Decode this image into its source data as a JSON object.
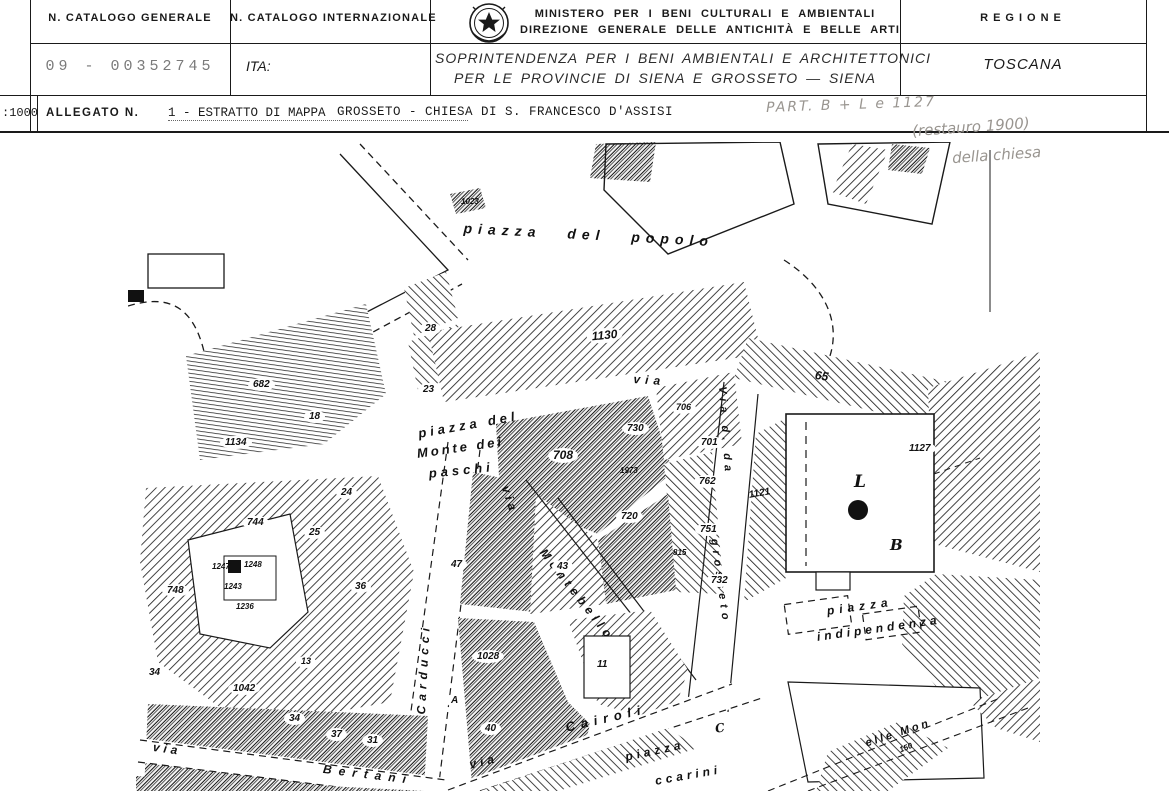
{
  "header": {
    "catalogo_generale": {
      "label": "N. CATALOGO GENERALE",
      "value": "09 - 00352745"
    },
    "catalogo_internazionale": {
      "label": "N. CATALOGO INTERNAZIONALE",
      "value": "ITA:"
    },
    "ministry": {
      "emblem_icon": "italian-state-emblem",
      "line1": "MINISTERO PER I BENI CULTURALI E AMBIENTALI",
      "line2": "DIREZIONE GENERALE DELLE ANTICHITÀ E BELLE ARTI",
      "soprintendenza_line1": "SOPRINTENDENZA PER I BENI AMBIENTALI E ARCHITETTONICI",
      "soprintendenza_line2": "PER LE PROVINCIE DI SIENA E GROSSETO — SIENA"
    },
    "regione": {
      "label": "REGIONE",
      "value": "TOSCANA"
    }
  },
  "allegato_row": {
    "scale": ":1000",
    "label": "ALLEGATO N.",
    "value": "1 - ESTRATTO DI MAPPA",
    "subject": "GROSSETO - CHIESA DI S. FRANCESCO D'ASSISI",
    "handwritten_note": "PART. B + L e 1127"
  },
  "handwritten_annotation": {
    "line1": "(restauro 1900)",
    "line2": "della chiesa"
  },
  "colors": {
    "ink": "#1a1a1a",
    "pencil": "#999590",
    "typewriter_gray": "#7a7a7a",
    "paper": "#ffffff"
  },
  "map": {
    "description": "cadastral-map-extract-1:1000",
    "labels": [
      {
        "t": "piazza del popolo",
        "x": 336,
        "y": 78,
        "rot": 3,
        "ls": 6,
        "ws": 16,
        "fs": 14,
        "kind": "street"
      },
      {
        "t": "piazza del",
        "x": 289,
        "y": 284,
        "rot": -10,
        "ls": 4,
        "fs": 13,
        "kind": "street"
      },
      {
        "t": "Monte dei",
        "x": 288,
        "y": 304,
        "rot": -8,
        "ls": 3,
        "fs": 13,
        "kind": "street"
      },
      {
        "t": "paschi",
        "x": 300,
        "y": 324,
        "rot": -6,
        "ls": 4,
        "fs": 13,
        "kind": "street"
      },
      {
        "t": "via",
        "x": 384,
        "y": 342,
        "rot": 72,
        "ls": 4,
        "fs": 12,
        "kind": "street"
      },
      {
        "t": "Montebello",
        "x": 420,
        "y": 404,
        "rot": 52,
        "ls": 5,
        "fs": 12,
        "kind": "street"
      },
      {
        "t": "Carducci",
        "x": 286,
        "y": 572,
        "rot": -87,
        "ls": 5,
        "fs": 12,
        "kind": "street"
      },
      {
        "t": "Via d. da",
        "x": 600,
        "y": 244,
        "rot": 86,
        "ls": 5,
        "fs": 11,
        "kind": "street"
      },
      {
        "t": "grosseto",
        "x": 592,
        "y": 396,
        "rot": 82,
        "ls": 5,
        "fs": 11,
        "kind": "street"
      },
      {
        "t": "via",
        "x": 506,
        "y": 230,
        "rot": 4,
        "ls": 5,
        "fs": 12,
        "kind": "street"
      },
      {
        "t": "via",
        "x": 26,
        "y": 598,
        "rot": 8,
        "ls": 4,
        "fs": 12,
        "kind": "street"
      },
      {
        "t": "Bertani",
        "x": 196,
        "y": 620,
        "rot": 7,
        "ls": 7,
        "fs": 12,
        "kind": "street"
      },
      {
        "t": "via",
        "x": 340,
        "y": 616,
        "rot": -14,
        "ls": 4,
        "fs": 12,
        "kind": "street"
      },
      {
        "t": "Cairoli",
        "x": 436,
        "y": 578,
        "rot": -13,
        "ls": 6,
        "fs": 13,
        "kind": "street"
      },
      {
        "t": "piazza",
        "x": 698,
        "y": 462,
        "rot": -8,
        "ls": 5,
        "fs": 12,
        "kind": "street"
      },
      {
        "t": "indipendenza",
        "x": 688,
        "y": 488,
        "rot": -8,
        "ls": 4,
        "fs": 12,
        "kind": "street"
      },
      {
        "t": "piazza",
        "x": 496,
        "y": 608,
        "rot": -12,
        "ls": 4,
        "fs": 12,
        "kind": "street"
      },
      {
        "t": "ccarini",
        "x": 526,
        "y": 632,
        "rot": -10,
        "ls": 4,
        "fs": 12,
        "kind": "street"
      },
      {
        "t": "elle Mon",
        "x": 736,
        "y": 596,
        "rot": -18,
        "ls": 3,
        "fs": 11,
        "kind": "street"
      },
      {
        "t": "1023",
        "x": 333,
        "y": 55,
        "fs": 8,
        "kind": "small"
      },
      {
        "t": "28",
        "x": 292,
        "y": 180,
        "kind": "parcel"
      },
      {
        "t": "23",
        "x": 290,
        "y": 241,
        "kind": "parcel"
      },
      {
        "t": "1130",
        "x": 458,
        "y": 188,
        "rot": -6,
        "fs": 12,
        "kind": "parcel"
      },
      {
        "t": "682",
        "x": 120,
        "y": 236,
        "kind": "parcel"
      },
      {
        "t": "18",
        "x": 176,
        "y": 268,
        "kind": "parcel"
      },
      {
        "t": "1134",
        "x": 92,
        "y": 294,
        "kind": "parcel"
      },
      {
        "t": "65",
        "x": 688,
        "y": 226,
        "rot": 8,
        "fs": 12,
        "kind": "small"
      },
      {
        "t": "708",
        "x": 420,
        "y": 306,
        "fs": 12,
        "kind": "parcel"
      },
      {
        "t": "730",
        "x": 494,
        "y": 280,
        "kind": "parcel"
      },
      {
        "t": "706",
        "x": 543,
        "y": 260,
        "fs": 9,
        "kind": "parcel"
      },
      {
        "t": "701",
        "x": 568,
        "y": 294,
        "kind": "parcel"
      },
      {
        "t": "1973",
        "x": 492,
        "y": 324,
        "fs": 8,
        "kind": "small"
      },
      {
        "t": "762",
        "x": 566,
        "y": 333,
        "kind": "parcel"
      },
      {
        "t": "720",
        "x": 488,
        "y": 368,
        "kind": "parcel"
      },
      {
        "t": "751",
        "x": 567,
        "y": 381,
        "kind": "parcel"
      },
      {
        "t": "815",
        "x": 545,
        "y": 406,
        "fs": 8,
        "kind": "small"
      },
      {
        "t": "732",
        "x": 578,
        "y": 432,
        "kind": "parcel"
      },
      {
        "t": "1121",
        "x": 620,
        "y": 348,
        "rot": -10,
        "fs": 10,
        "kind": "small"
      },
      {
        "t": "1127",
        "x": 776,
        "y": 300,
        "kind": "parcel"
      },
      {
        "t": "L",
        "x": 726,
        "y": 330,
        "fs": 17,
        "kind": "letter"
      },
      {
        "t": "B",
        "x": 762,
        "y": 394,
        "fs": 15,
        "kind": "letter"
      },
      {
        "t": "C",
        "x": 586,
        "y": 580,
        "fs": 12,
        "rot": -10,
        "kind": "letter"
      },
      {
        "t": "47",
        "x": 318,
        "y": 416,
        "kind": "parcel"
      },
      {
        "t": "43",
        "x": 424,
        "y": 418,
        "kind": "parcel"
      },
      {
        "t": "24",
        "x": 208,
        "y": 344,
        "kind": "parcel"
      },
      {
        "t": "25",
        "x": 176,
        "y": 384,
        "kind": "parcel"
      },
      {
        "t": "744",
        "x": 114,
        "y": 374,
        "kind": "parcel"
      },
      {
        "t": "748",
        "x": 34,
        "y": 442,
        "kind": "parcel"
      },
      {
        "t": "36",
        "x": 222,
        "y": 438,
        "kind": "parcel"
      },
      {
        "t": "1247",
        "x": 84,
        "y": 420,
        "fs": 8,
        "kind": "small"
      },
      {
        "t": "1248",
        "x": 116,
        "y": 418,
        "fs": 8,
        "kind": "small"
      },
      {
        "t": "1243",
        "x": 96,
        "y": 440,
        "fs": 8,
        "kind": "small"
      },
      {
        "t": "1236",
        "x": 108,
        "y": 460,
        "fs": 8,
        "kind": "small"
      },
      {
        "t": "13",
        "x": 168,
        "y": 514,
        "fs": 9,
        "kind": "parcel"
      },
      {
        "t": "34",
        "x": 16,
        "y": 524,
        "kind": "parcel"
      },
      {
        "t": "1042",
        "x": 100,
        "y": 540,
        "kind": "parcel"
      },
      {
        "t": "34",
        "x": 156,
        "y": 570,
        "kind": "parcel"
      },
      {
        "t": "37",
        "x": 198,
        "y": 586,
        "kind": "parcel"
      },
      {
        "t": "31",
        "x": 234,
        "y": 592,
        "kind": "parcel"
      },
      {
        "t": "A",
        "x": 318,
        "y": 552,
        "kind": "parcel"
      },
      {
        "t": "40",
        "x": 352,
        "y": 580,
        "kind": "parcel"
      },
      {
        "t": "1028",
        "x": 344,
        "y": 508,
        "kind": "parcel"
      },
      {
        "t": "11",
        "x": 464,
        "y": 516,
        "kind": "parcel"
      },
      {
        "t": "150",
        "x": 770,
        "y": 604,
        "fs": 8,
        "rot": -22,
        "kind": "small"
      }
    ]
  }
}
